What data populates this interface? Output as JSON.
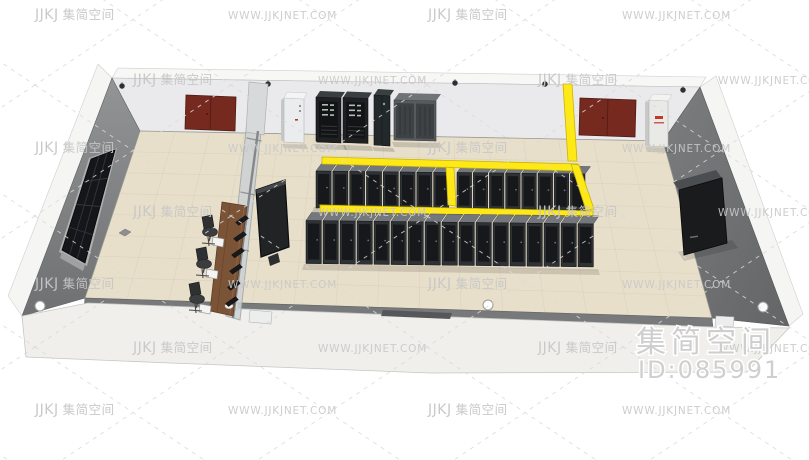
{
  "image": {
    "title": "3D data center room model preview",
    "width": 809,
    "height": 460
  },
  "watermark": {
    "brand_logo": "JJKJ",
    "brand_name": "集简空间",
    "url": "WWW.JJKJNET.COM",
    "text_color": "#c7c7c7",
    "grid": {
      "row_ys": [
        19,
        84,
        152,
        216,
        288,
        352,
        414
      ],
      "odd_xs": [
        35,
        228,
        428,
        622
      ],
      "even_xs": [
        133,
        318,
        538,
        718
      ],
      "sequence": [
        "brand",
        "url",
        "brand",
        "url"
      ]
    },
    "badge": {
      "name": "集简空间",
      "id": "ID:085991",
      "color": "#cecece"
    }
  },
  "scene": {
    "description": "isometric 3D render of a server room with monitoring area",
    "room": {
      "floor_color": "#e8dfcb",
      "back_wall_color": "#eaeaec",
      "left_wall_color": "#8a8c8f",
      "right_wall_color": "#737577",
      "front_wall_color": "#f0efeb",
      "door_color": "#76291f",
      "glass_color": "#ccd2d4"
    },
    "cable_tray": {
      "color": "#ffe818",
      "edge_color": "#c7b500"
    },
    "racks": {
      "top_color": "#74787d",
      "frame_color": "#2f3235",
      "door_color": "#17181b",
      "rows": [
        {
          "name": "back-row-left",
          "count": 8,
          "x0": 316,
          "pitch": 16.8,
          "y0": 171,
          "h": 37,
          "slope": 0.012,
          "ddx": 5.5,
          "ddy": -7.5
        },
        {
          "name": "back-row-right",
          "count": 8,
          "x0": 457,
          "pitch": 16.2,
          "y0": 172.5,
          "h": 37,
          "slope": 0.012,
          "ddx": 5.5,
          "ddy": -7.5
        },
        {
          "name": "front-row",
          "count": 17,
          "x0": 306,
          "pitch": 17.0,
          "y0": 220.5,
          "h": 43,
          "slope": 0.012,
          "ddx": 5.5,
          "ddy": -8
        }
      ]
    },
    "cameras": {
      "positions": [
        [
          122,
          86
        ],
        [
          268,
          84
        ],
        [
          455,
          83
        ],
        [
          545,
          84
        ],
        [
          683,
          90
        ]
      ]
    },
    "wall_knobs": {
      "positions": [
        [
          40,
          306
        ],
        [
          233,
          306
        ],
        [
          488,
          305
        ],
        [
          763,
          307
        ]
      ]
    },
    "chairs": {
      "positions": [
        [
          211,
          228
        ],
        [
          205,
          260
        ],
        [
          198,
          295
        ]
      ]
    },
    "desk_monitors": {
      "count": 6
    },
    "floor_grid": {
      "rows": 8,
      "cols": 15,
      "corners": {
        "back_left": [
          140,
          131
        ],
        "back_right": [
          663,
          141
        ],
        "front_right": [
          712,
          318
        ],
        "front_left": [
          85,
          298
        ]
      }
    },
    "equipment": [
      "ups-cabinet",
      "power-cabinet-a",
      "power-cabinet-b",
      "network-cabinet",
      "crac-unit",
      "fire-hydrant-cabinet",
      "right-wall-display",
      "video-wall",
      "glass-partition",
      "operator-desk"
    ]
  }
}
